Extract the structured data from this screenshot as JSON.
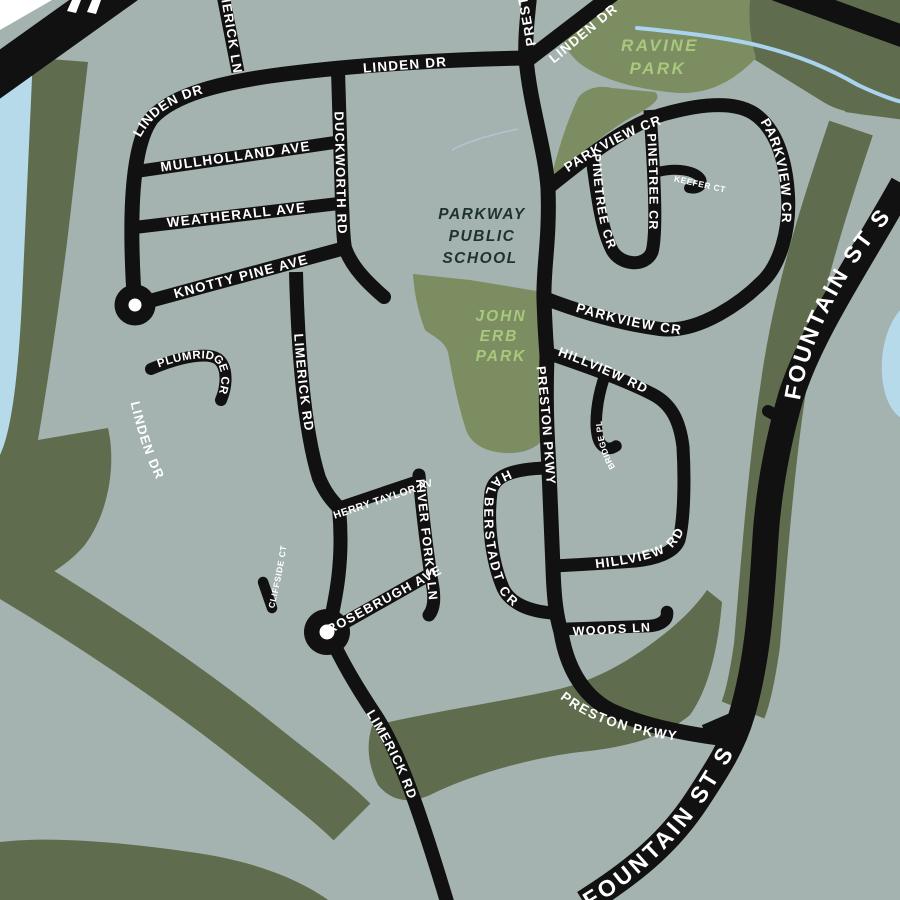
{
  "map": {
    "colors": {
      "background": "#a4b3b0",
      "woods": "#5f6d4e",
      "park": "#7d8d62",
      "water": "#b7daeb",
      "stream": "#a9d3ee",
      "road": "#111111",
      "road_label": "#ffffff",
      "park_label": "#a8c87e",
      "school_label": "#1e3231",
      "page_corner": "#ffffff"
    },
    "streets": {
      "linden": "LINDEN DR",
      "limerick_ln": "LIMERICK LN",
      "mullholland": "MULLHOLLAND AVE",
      "duckworth": "DUCKWORTH RD",
      "weatherall": "WEATHERALL AVE",
      "knotty_pine": "KNOTTY PINE AVE",
      "plumridge": "PLUMRIDGE CR",
      "limerick_rd": "LIMERICK RD",
      "cherry_taylor": "CHERRY TAYLOR AVE",
      "river_forks": "RIVER FORKS LN",
      "rosebrugh": "ROSEBRUGH AVE",
      "cliffside": "CLIFFSIDE CT",
      "halberstadt": "HALBERSTADT CR",
      "woods_ln": "WOODS LN",
      "preston": "PRESTON PKWY",
      "parkview": "PARKVIEW CR",
      "pinetree": "PINETREE CR",
      "keefer": "KEEFER CT",
      "hillview": "HILLVIEW RD",
      "shingle_bridge": "SHINGLE BRIDGE PL",
      "fountain": "FOUNTAIN ST S"
    },
    "parks": {
      "ravine": [
        "RAVINE",
        "PARK"
      ],
      "john_erb": [
        "JOHN",
        "ERB",
        "PARK"
      ]
    },
    "school": [
      "PARKWAY",
      "PUBLIC",
      "SCHOOL"
    ]
  }
}
